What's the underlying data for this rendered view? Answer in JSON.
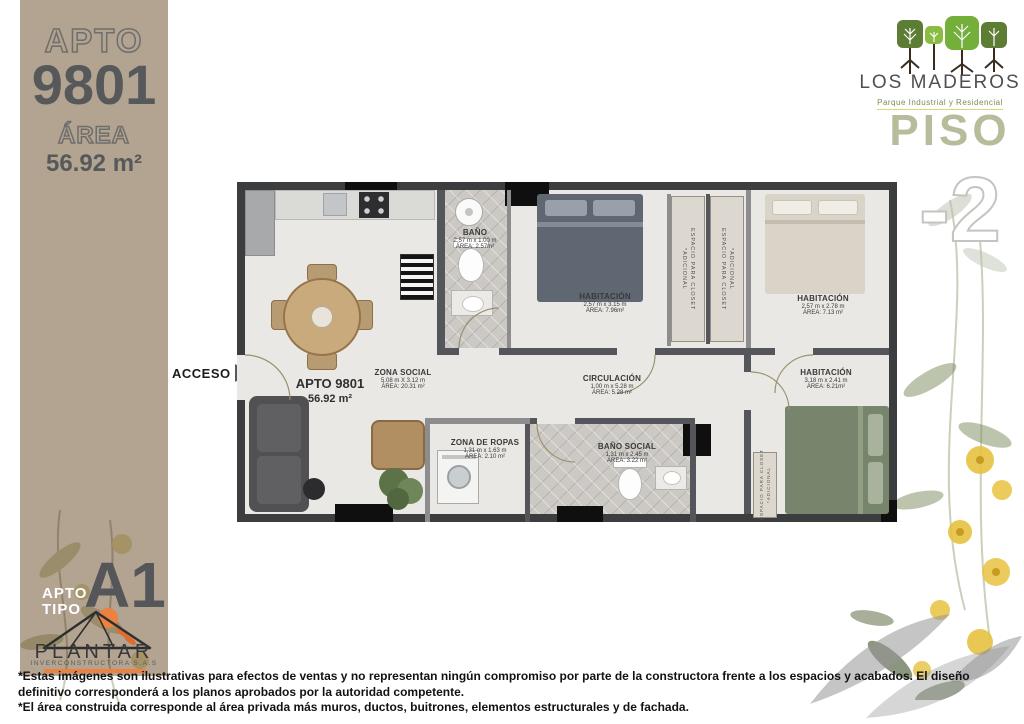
{
  "sidebar": {
    "apto_label": "APTO",
    "apto_number": "9801",
    "area_label": "ÁREA",
    "area_value": "56.92 m²",
    "tipo_line1": "APTO",
    "tipo_line2": "TIPO",
    "tipo_value": "A1"
  },
  "brand": {
    "name": "LOS MADEROS",
    "tagline": "Parque Industrial y Residencial",
    "floor_label": "PISO",
    "floor_number": "-2"
  },
  "builder": {
    "name": "PLANTAR",
    "subtitle": "INVERCONSTRUCTORA S.A.S"
  },
  "plan": {
    "access_label": "ACCESO",
    "unit_label": "APTO 9801",
    "unit_area": "56.92 m²",
    "rooms": {
      "bano": {
        "name": "BAÑO",
        "dims": "2.57 m x 1.00 m",
        "area": "ÁREA: 2.57m²"
      },
      "habitacion_1": {
        "name": "HABITACIÓN",
        "dims": "2.57 m x 3.15 m",
        "area": "ÁREA: 7.96m²"
      },
      "habitacion_2": {
        "name": "HABITACIÓN",
        "dims": "2.57 m x 2.78 m",
        "area": "ÁREA: 7.13 m²"
      },
      "habitacion_3": {
        "name": "HABITACIÓN",
        "dims": "3.18 m x 2.41 m",
        "area": "ÁREA: 6.21m²"
      },
      "zona_social": {
        "name": "ZONA SOCIAL",
        "dims": "5.08 m X 3.12 m",
        "area": "ÁREA: 20.31 m²"
      },
      "circulacion": {
        "name": "CIRCULACIÓN",
        "dims": "1.00 m x 5.28 m",
        "area": "ÁREA: 5.28 m²"
      },
      "zona_de_ropas": {
        "name": "ZONA DE ROPAS",
        "dims": "1.31 m x 1.63 m",
        "area": "ÁREA: 2.10 m²"
      },
      "bano_social": {
        "name": "BAÑO SOCIAL",
        "dims": "1.31 m x 2.45 m",
        "area": "ÁREA: 3.22 m²"
      }
    },
    "closet": {
      "primary": "ESPACIO PARA CLOSET",
      "secondary": "*ADICIONAL"
    }
  },
  "disclaimer": {
    "line1": "*Estas imágenes son ilustrativas para efectos de ventas y no representan ningún compromiso por parte de la constructora frente a los espacios y acabados. El diseño",
    "line2": "definitivo corresponderá a los planos aprobados por la autoridad competente.",
    "line3": "*El área construida corresponde al área privada más muros, ductos, buitrones, elementos estructurales y de fachada."
  },
  "colors": {
    "sidebar_beige": "#b2a491",
    "dark_gray": "#57585a",
    "sage_green": "#b5bd9b",
    "accent_orange": "#ec8140",
    "tree_dark_green": "#5d7c34",
    "tree_light_green": "#74ae3b",
    "wall_dark": "#3c3d3f"
  }
}
